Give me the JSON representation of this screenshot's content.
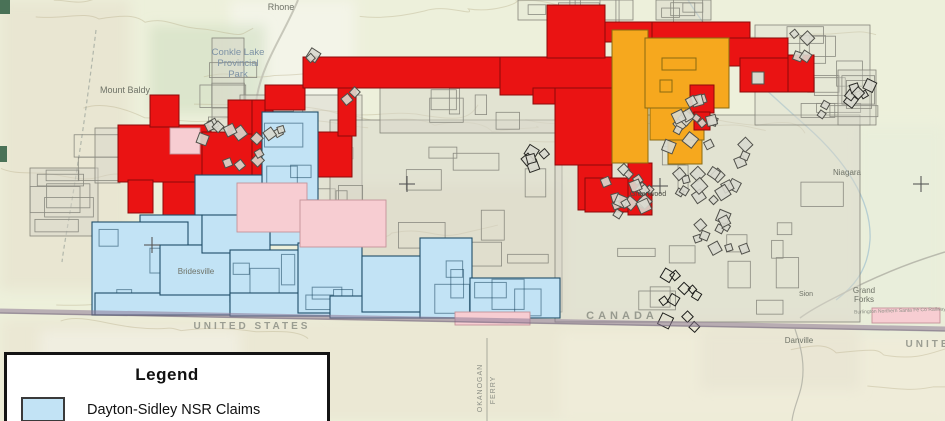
{
  "map": {
    "labels": {
      "rhone": "Rhone",
      "conkle_line1": "Conkle Lake",
      "conkle_line2": "Provincial",
      "conkle_line3": "Park",
      "mount_baldy": "Mount Baldy",
      "bridesville": "Bridesville",
      "greenwood": "Greenwood",
      "niagara": "Niagara",
      "sion": "Sion",
      "canada": "CANADA",
      "united_states_west": "UNITED STATES",
      "united_states_east": "UNITE",
      "grand_forks_line1": "Grand",
      "grand_forks_line2": "Forks",
      "danville": "Danville",
      "railway": "Burlington Northern Santa Fe Co Railway",
      "okanogan_county": "OKANOGAN",
      "ferry_county": "FERRY"
    },
    "claims": {
      "red": "#ea1313",
      "orange": "#f6a81e",
      "blue": "#c2e3f5",
      "pink": "#f7cdd2"
    }
  },
  "legend": {
    "title": "Legend",
    "items": [
      {
        "label": "Dayton-Sidley NSR Claims",
        "color": "#c2e3f5"
      }
    ]
  }
}
